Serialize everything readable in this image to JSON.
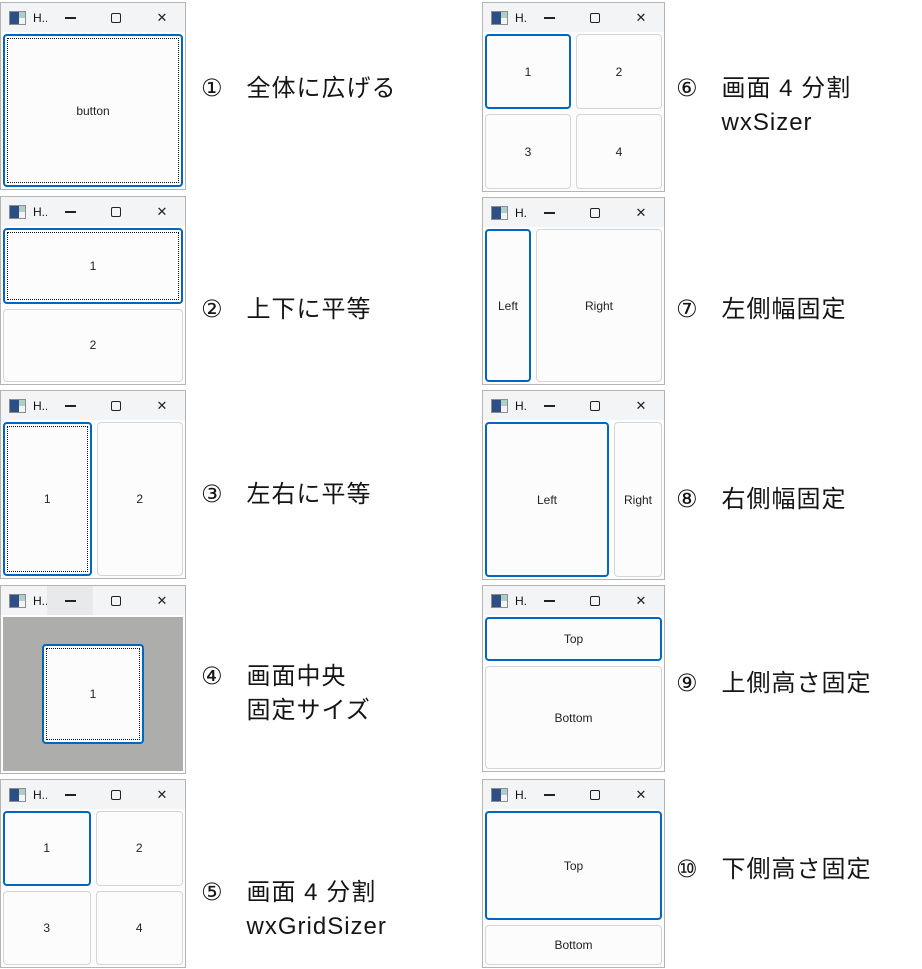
{
  "chrome": {
    "title": "H...",
    "close_glyph": "✕"
  },
  "colors": {
    "accent": "#0067c0",
    "titlebar": "#f3f4f6",
    "window_border": "#b4b4b4",
    "button_border": "#d5d5d5",
    "button_bg": "#fcfcfd",
    "gray_client": "#adadab"
  },
  "windows": [
    {
      "name": "expand-full",
      "x": 0,
      "y": 2,
      "w": 186,
      "h": 188,
      "layout": "single",
      "buttons": [
        {
          "label": "button",
          "focused": true,
          "dotted": true
        }
      ]
    },
    {
      "name": "vertical-equal",
      "x": 0,
      "y": 196,
      "w": 186,
      "h": 189,
      "layout": "column",
      "buttons": [
        {
          "label": "1",
          "focused": true,
          "dotted": true
        },
        {
          "label": "2"
        }
      ]
    },
    {
      "name": "horizontal-equal",
      "x": 0,
      "y": 390,
      "w": 186,
      "h": 189,
      "layout": "row",
      "buttons": [
        {
          "label": "1",
          "focused": true,
          "dotted": true
        },
        {
          "label": "2"
        }
      ]
    },
    {
      "name": "centered-fixed",
      "x": 0,
      "y": 585,
      "w": 186,
      "h": 189,
      "layout": "center",
      "client_bg": "#adadab",
      "minimize_hover": true,
      "buttons": [
        {
          "label": "1",
          "focused": true,
          "dotted": true,
          "width": 102,
          "height": 100
        }
      ]
    },
    {
      "name": "grid-sizer-4split",
      "x": 0,
      "y": 779,
      "w": 186,
      "h": 189,
      "layout": "grid",
      "buttons": [
        {
          "label": "1",
          "focused": true
        },
        {
          "label": "2"
        },
        {
          "label": "3"
        },
        {
          "label": "4"
        }
      ]
    },
    {
      "name": "box-sizer-4split",
      "x": 482,
      "y": 2,
      "w": 183,
      "h": 190,
      "layout": "grid",
      "buttons": [
        {
          "label": "1",
          "focused": true
        },
        {
          "label": "2"
        },
        {
          "label": "3"
        },
        {
          "label": "4"
        }
      ]
    },
    {
      "name": "left-fixed-width",
      "x": 482,
      "y": 197,
      "w": 183,
      "h": 188,
      "layout": "row",
      "buttons": [
        {
          "label": "Left",
          "focused": true,
          "width": 46
        },
        {
          "label": "Right"
        }
      ]
    },
    {
      "name": "right-fixed-width",
      "x": 482,
      "y": 390,
      "w": 183,
      "h": 190,
      "layout": "row",
      "buttons": [
        {
          "label": "Left",
          "focused": true
        },
        {
          "label": "Right",
          "width": 48
        }
      ]
    },
    {
      "name": "top-fixed-height",
      "x": 482,
      "y": 585,
      "w": 183,
      "h": 187,
      "layout": "column",
      "buttons": [
        {
          "label": "Top",
          "focused": true,
          "height": 44
        },
        {
          "label": "Bottom"
        }
      ]
    },
    {
      "name": "bottom-fixed-height",
      "x": 482,
      "y": 779,
      "w": 183,
      "h": 189,
      "layout": "column",
      "buttons": [
        {
          "label": "Top",
          "focused": true
        },
        {
          "label": "Bottom",
          "height": 40
        }
      ]
    }
  ],
  "labels": [
    {
      "num": "①",
      "lines": [
        "全体に広げる"
      ],
      "x": 201,
      "y": 72
    },
    {
      "num": "②",
      "lines": [
        "上下に平等"
      ],
      "x": 201,
      "y": 293
    },
    {
      "num": "③",
      "lines": [
        "左右に平等"
      ],
      "x": 201,
      "y": 478
    },
    {
      "num": "④",
      "lines": [
        "画面中央",
        "固定サイズ"
      ],
      "x": 201,
      "y": 660
    },
    {
      "num": "⑤",
      "lines": [
        "画面 4 分割",
        "wxGridSizer"
      ],
      "x": 201,
      "y": 876
    },
    {
      "num": "⑥",
      "lines": [
        "画面 4 分割",
        "wxSizer"
      ],
      "x": 676,
      "y": 72
    },
    {
      "num": "⑦",
      "lines": [
        "左側幅固定"
      ],
      "x": 676,
      "y": 293
    },
    {
      "num": "⑧",
      "lines": [
        "右側幅固定"
      ],
      "x": 676,
      "y": 483
    },
    {
      "num": "⑨",
      "lines": [
        "上側高さ固定"
      ],
      "x": 676,
      "y": 667
    },
    {
      "num": "⑩",
      "lines": [
        "下側高さ固定"
      ],
      "x": 676,
      "y": 853
    }
  ]
}
